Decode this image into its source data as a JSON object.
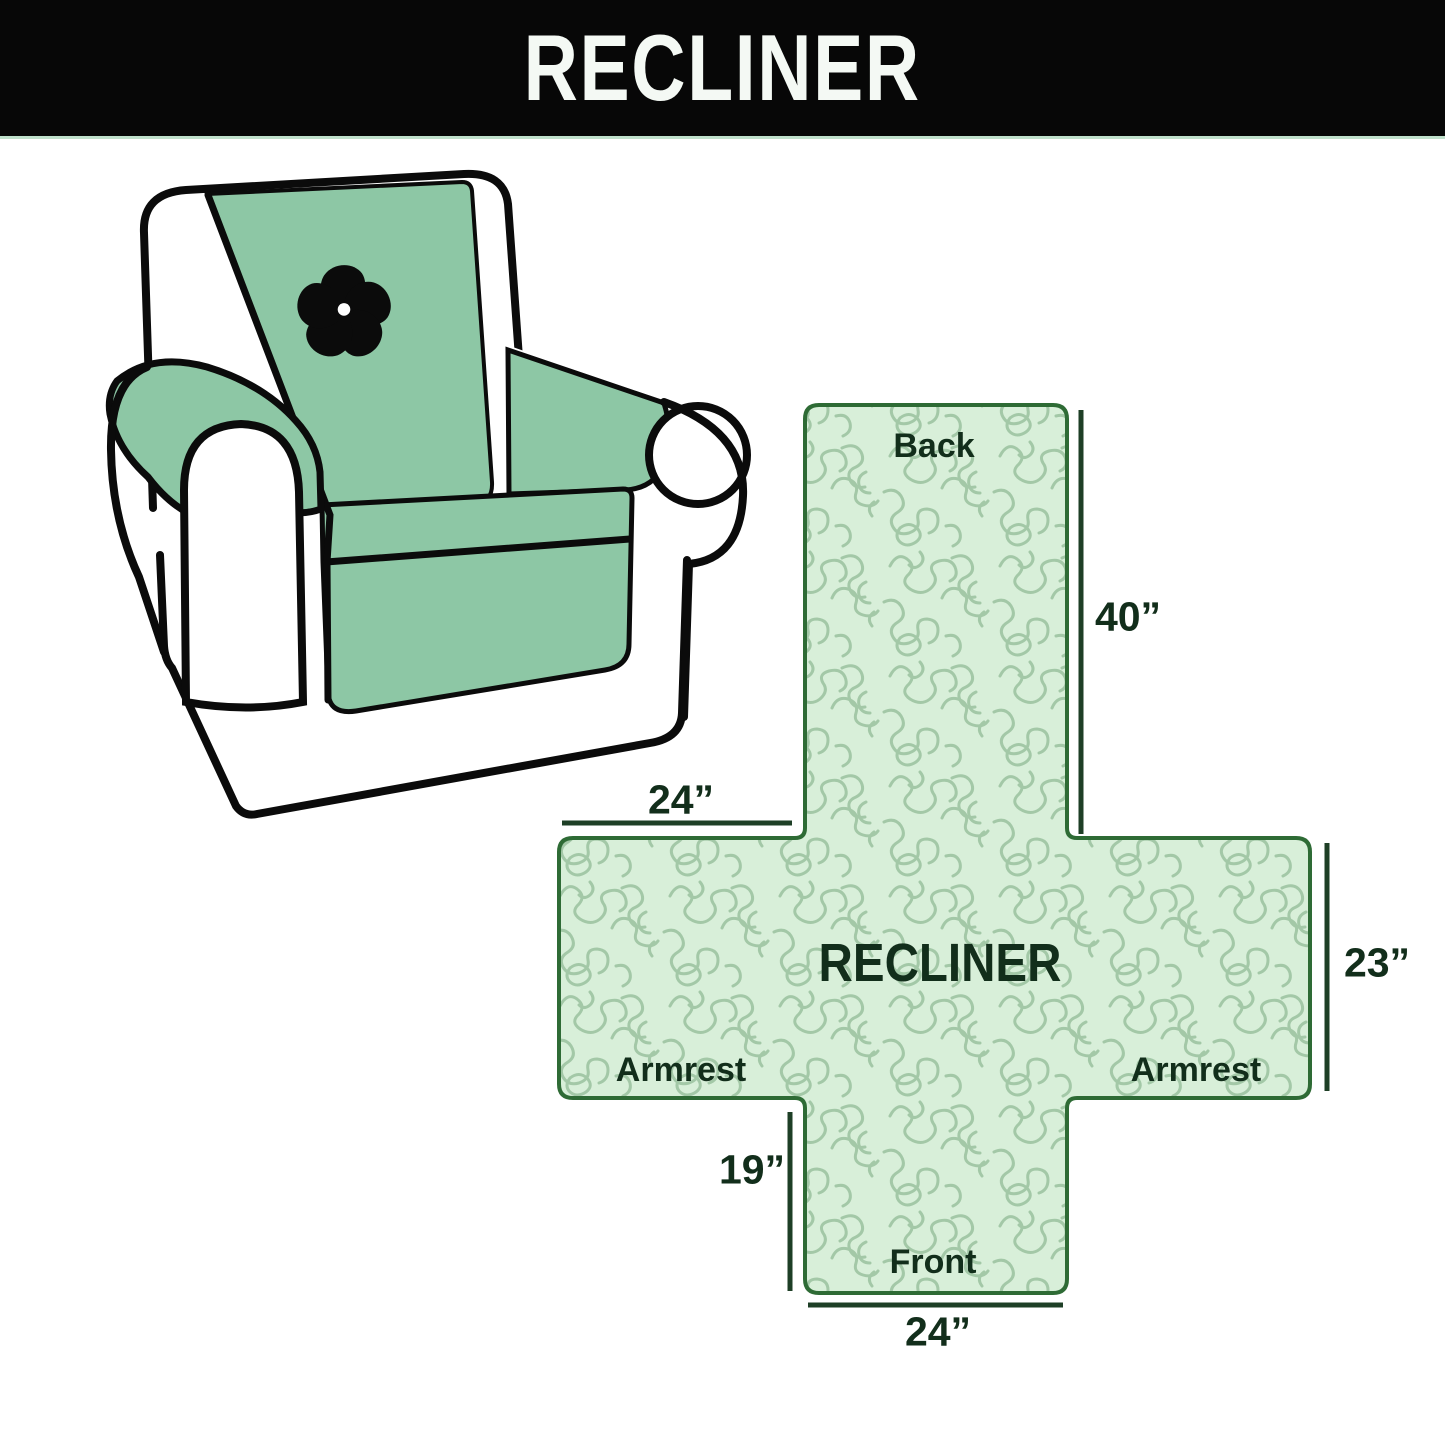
{
  "banner": {
    "title": "RECLINER"
  },
  "chair": {
    "logo_icon": "pinwheel-icon",
    "cover_color": "#8dc7a5",
    "outline_color": "#0b0b0b"
  },
  "diagram": {
    "center_label": "RECLINER",
    "back_label": "Back",
    "front_label": "Front",
    "armrest_left_label": "Armrest",
    "armrest_right_label": "Armrest",
    "dim_back_height": "40”",
    "dim_top_width": "24”",
    "dim_side_height": "23”",
    "dim_front_height": "19”",
    "dim_front_width": "24”",
    "fill_color": "#d8efd9",
    "pattern_color": "#a3c8a7",
    "border_color": "#2e6b35",
    "line_color": "#1e3f26",
    "text_color": "#122e1b"
  }
}
